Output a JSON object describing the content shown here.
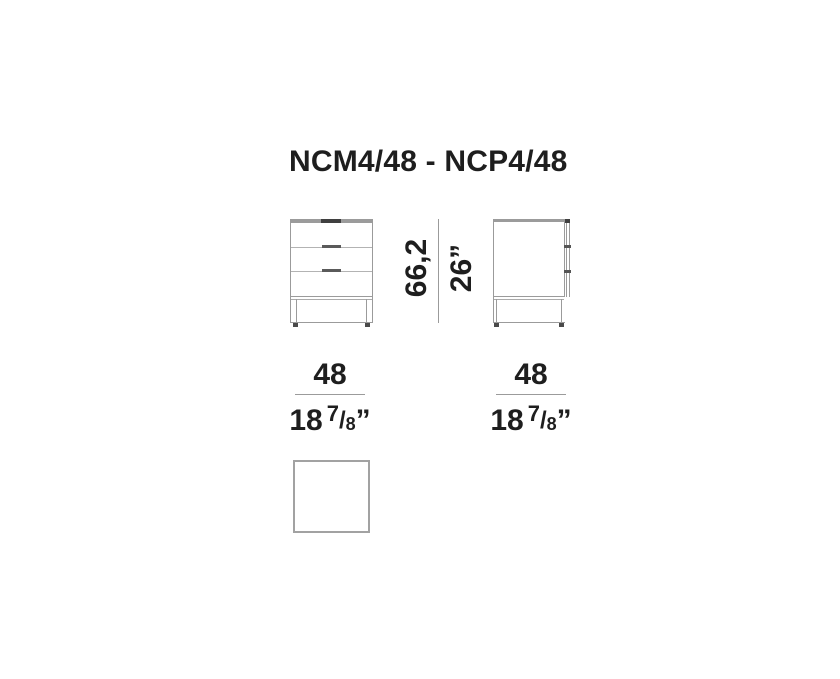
{
  "title": "NCM4/48 - NCP4/48",
  "dimensions": {
    "height": {
      "metric": "66,2",
      "imperial": "26”"
    },
    "width_front": {
      "metric": "48",
      "imperial_whole": "18",
      "fraction_numerator": "7",
      "fraction_slash": "/",
      "fraction_denominator": "8",
      "unit_mark": "”"
    },
    "width_side": {
      "metric": "48",
      "imperial_whole": "18",
      "fraction_numerator": "7",
      "fraction_slash": "/",
      "fraction_denominator": "8",
      "unit_mark": "”"
    }
  },
  "colors": {
    "line_gray": "#9b9b9b",
    "divider_gray": "#b3b3b3",
    "accent_dark": "#3f3f3f",
    "handle_dark": "#5a5a5a",
    "text": "#1e1e1e",
    "background": "#ffffff"
  }
}
